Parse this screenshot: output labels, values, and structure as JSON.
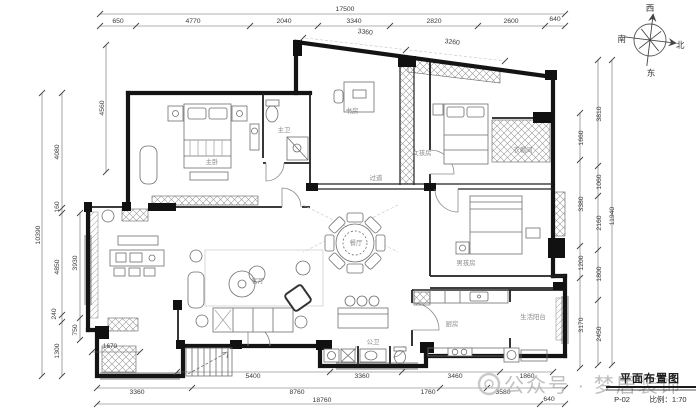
{
  "dims": {
    "top_total": "17500",
    "top": [
      "650",
      "4770",
      "2040",
      "3340",
      "2820",
      "2600",
      "640"
    ],
    "top2": [
      "3360",
      "3260"
    ],
    "left_total": "10390",
    "left": [
      "4080",
      "160",
      "4850",
      "240",
      "1300"
    ],
    "left_inner": [
      "4560",
      "3930",
      "750"
    ],
    "right_inner": [
      "1660",
      "3380",
      "1200",
      "3170"
    ],
    "right_mid": [
      "3810",
      "1060",
      "2160",
      "1800",
      "2450"
    ],
    "right_total": "11940",
    "bottom1": [
      "5400",
      "3360",
      "3460",
      "1860"
    ],
    "bottom2": [
      "3360",
      "8760",
      "1760",
      "3580"
    ],
    "bottom_end": "640",
    "bottom_total": "18760",
    "interior_1": "1670"
  },
  "rooms": {
    "master": "主卧",
    "master_bath": "主卫",
    "study": "书房",
    "girl": "女孩房",
    "cloak": "衣帽间",
    "boy": "男孩房",
    "corridor": "过道",
    "dining": "餐厅",
    "living": "客厅",
    "kitchen": "厨房",
    "service_balcony": "生活阳台",
    "bath": "公卫"
  },
  "compass": {
    "west": "西",
    "south": "南",
    "north": "北",
    "east": "东"
  },
  "titleblock": {
    "title": "平面布置图",
    "sheet": "P-02",
    "scale": "比例：1:70"
  },
  "watermark": {
    "text": "公众号 · 梦居装饰"
  }
}
